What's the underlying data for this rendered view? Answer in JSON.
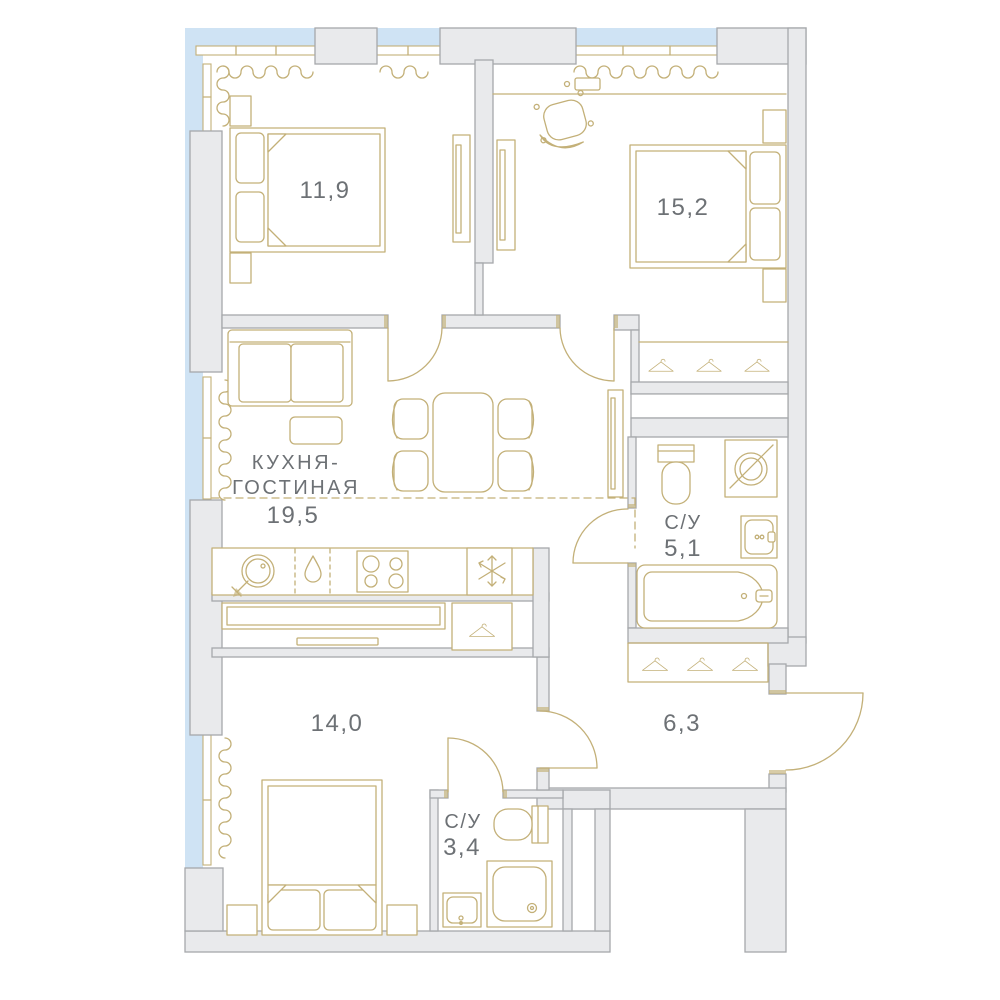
{
  "plan": {
    "type": "apartment-floor-plan",
    "rooms": {
      "bedroom1": {
        "area": "11,9"
      },
      "bedroom2": {
        "area": "15,2"
      },
      "kitchen_living": {
        "name1": "КУХНЯ-",
        "name2": "ГОСТИНАЯ",
        "area": "19,5"
      },
      "bathroom1": {
        "name": "С/У",
        "area": "5,1"
      },
      "bedroom3": {
        "area": "14,0"
      },
      "hallway": {
        "area": "6,3"
      },
      "bathroom2": {
        "name": "С/У",
        "area": "3,4"
      }
    }
  },
  "icons": {
    "fridge-icon": "snowflake",
    "kitchen-sink-icon": "circle-with-tap",
    "hob-icon": "four-burner-stove",
    "water-drop-icon": "teardrop",
    "hanger-icon": "clothes-hanger",
    "washing-machine-icon": "circle-with-diagonal",
    "shower-drain-icon": "dot-circle"
  },
  "colors": {
    "outside": "#cfe3f4",
    "wall_fill": "#e9eaec",
    "wall_stroke": "#a6a8ab",
    "furniture": "#c3b078",
    "label_text": "#6d7175",
    "background": "#ffffff"
  }
}
